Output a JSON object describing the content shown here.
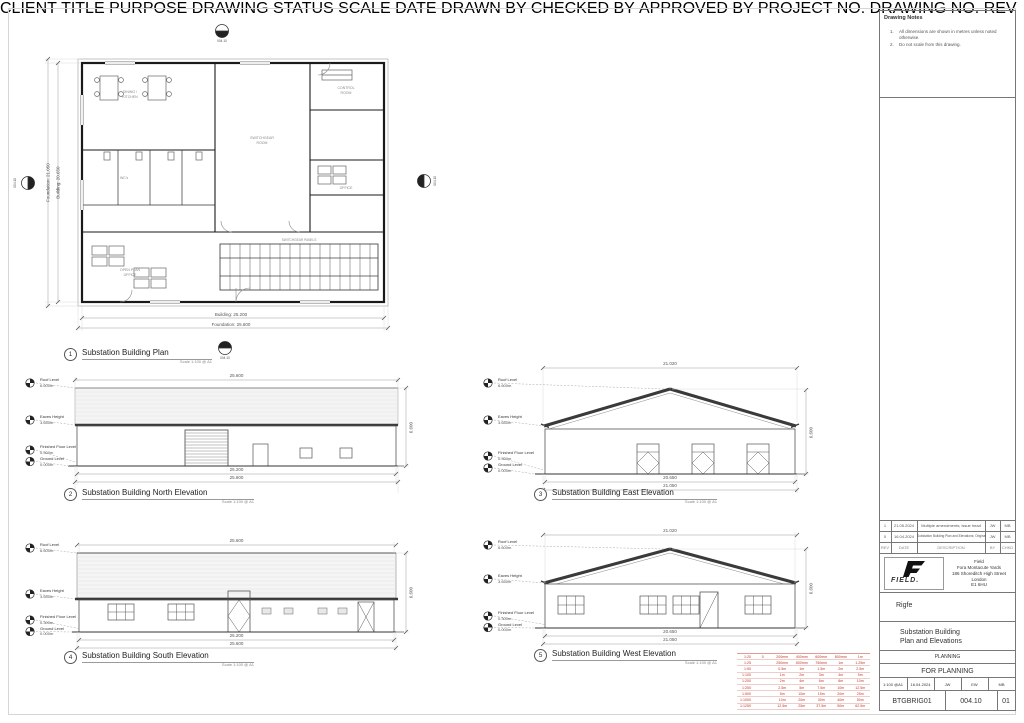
{
  "notes": {
    "title": "Drawing Notes",
    "items": [
      {
        "num": "1.",
        "text": "All dimensions are shown in metres unless noted otherwise."
      },
      {
        "num": "2.",
        "text": "Do not scale from this drawing."
      }
    ]
  },
  "plan": {
    "num": "1",
    "title": "Substation Building Plan",
    "scale_note": "Scale 1:100 @ A1",
    "marker_ref": "004.10",
    "dim_bottom_building": "Building: 25.200",
    "dim_bottom_foundation": "Foundation: 25.600",
    "dim_left_foundation": "Foundation: 21.050",
    "dim_left_building": "Building: 20.650",
    "rooms": {
      "dining": "DINING /\nKITCHEN",
      "wc": "WC's",
      "switchroom": "SWITCHGEAR\nROOM",
      "control": "CONTROL\nROOM",
      "office_right": "OFFICE",
      "open_office": "OPEN PLAN\nOFFICE",
      "panels": "SWITCHGEAR PANELS"
    }
  },
  "levels": {
    "roof_label": "Roof Level",
    "roof_value": "6.600m",
    "eaves_label": "Eaves Height",
    "eaves_value": "3.650m",
    "ffl_label": "Finished Floor Level",
    "ffl_value": "0.300m",
    "gl_label": "Ground Level",
    "gl_value": "0.000m"
  },
  "north": {
    "num": "2",
    "title": "Substation Building North Elevation",
    "scale_note": "Scale 1:100 @ A1",
    "dim_top": "25.600",
    "dim_bottom_building": "25.200",
    "dim_bottom_foundation": "25.600",
    "dim_height": "6.600"
  },
  "east": {
    "num": "3",
    "title": "Substation Building East Elevation",
    "scale_note": "Scale 1:100 @ A1",
    "dim_top": "21.020",
    "dim_bottom_building": "20.650",
    "dim_bottom_foundation": "21.050",
    "dim_height": "6.600"
  },
  "south": {
    "num": "4",
    "title": "Substation Building South Elevation",
    "scale_note": "Scale 1:100 @ A1",
    "dim_top": "25.600",
    "dim_bottom_building": "25.200",
    "dim_bottom_foundation": "25.600",
    "dim_height": "6.600"
  },
  "west": {
    "num": "5",
    "title": "Substation Building West Elevation",
    "scale_note": "Scale 1:100 @ A1",
    "dim_top": "21.020",
    "dim_bottom_building": "20.650",
    "dim_bottom_foundation": "21.050",
    "dim_height": "6.600"
  },
  "revisions": {
    "header": {
      "rev": "REV",
      "date": "DATE",
      "description": "DESCRIPTION",
      "by": "BY",
      "chkd": "CHKD"
    },
    "rows": [
      {
        "rev": "1",
        "date": "21.05.2024",
        "description": "Multiple amendments; issue head",
        "by": "JW",
        "chkd": "MB"
      },
      {
        "rev": "0",
        "date": "16.04.2024",
        "description": "Substation Building Plan and Elevations; Original",
        "by": "JW",
        "chkd": "MB"
      }
    ]
  },
  "titleblock": {
    "company_name": "FIELD.",
    "address": "Field\nFora Montacute Yards\n186 Shoreditch High Street\nLondon\nE1 6HU",
    "client_label": "CLIENT",
    "client": "Rigfe",
    "title_label": "TITLE",
    "title": "Substation Building\nPlan and Elevations",
    "purpose_label": "PURPOSE",
    "purpose": "PLANNING",
    "status_label": "DRAWING STATUS",
    "status": "FOR PLANNING",
    "scale_label": "SCALE",
    "scale": "1:100 @A1",
    "date_label": "DATE",
    "date": "16.04.2024",
    "drawn_label": "DRAWN BY",
    "drawn": "JW",
    "checked_label": "CHECKED BY",
    "checked": "EW",
    "approved_label": "APPROVED BY",
    "approved": "MB",
    "project_label": "PROJECT NO.",
    "project_no": "BTGBRIG01",
    "drawing_label": "DRAWING NO.",
    "drawing_no": "004.10",
    "rev_label": "REV",
    "rev": "01"
  },
  "scalebar": {
    "color": "#c0392b",
    "rows": [
      {
        "label": "1:20",
        "ticks": [
          "0",
          "200mm",
          "400mm",
          "600mm",
          "800mm",
          "1m"
        ]
      },
      {
        "label": "1:25",
        "ticks": [
          "",
          "250mm",
          "500mm",
          "750mm",
          "1m",
          "1.25m"
        ]
      },
      {
        "label": "1:50",
        "ticks": [
          "",
          "0.5m",
          "1m",
          "1.5m",
          "2m",
          "2.5m"
        ]
      },
      {
        "label": "1:100",
        "ticks": [
          "",
          "1m",
          "2m",
          "3m",
          "4m",
          "5m"
        ]
      },
      {
        "label": "1:200",
        "ticks": [
          "",
          "2m",
          "4m",
          "6m",
          "8m",
          "10m"
        ]
      },
      {
        "label": "1:250",
        "ticks": [
          "",
          "2.5m",
          "5m",
          "7.5m",
          "10m",
          "12.5m"
        ]
      },
      {
        "label": "1:500",
        "ticks": [
          "",
          "5m",
          "10m",
          "15m",
          "20m",
          "25m"
        ]
      },
      {
        "label": "1:1000",
        "ticks": [
          "",
          "10m",
          "20m",
          "30m",
          "40m",
          "50m"
        ]
      },
      {
        "label": "1:1250",
        "ticks": [
          "",
          "12.5m",
          "25m",
          "37.5m",
          "50m",
          "62.5m"
        ]
      }
    ]
  }
}
